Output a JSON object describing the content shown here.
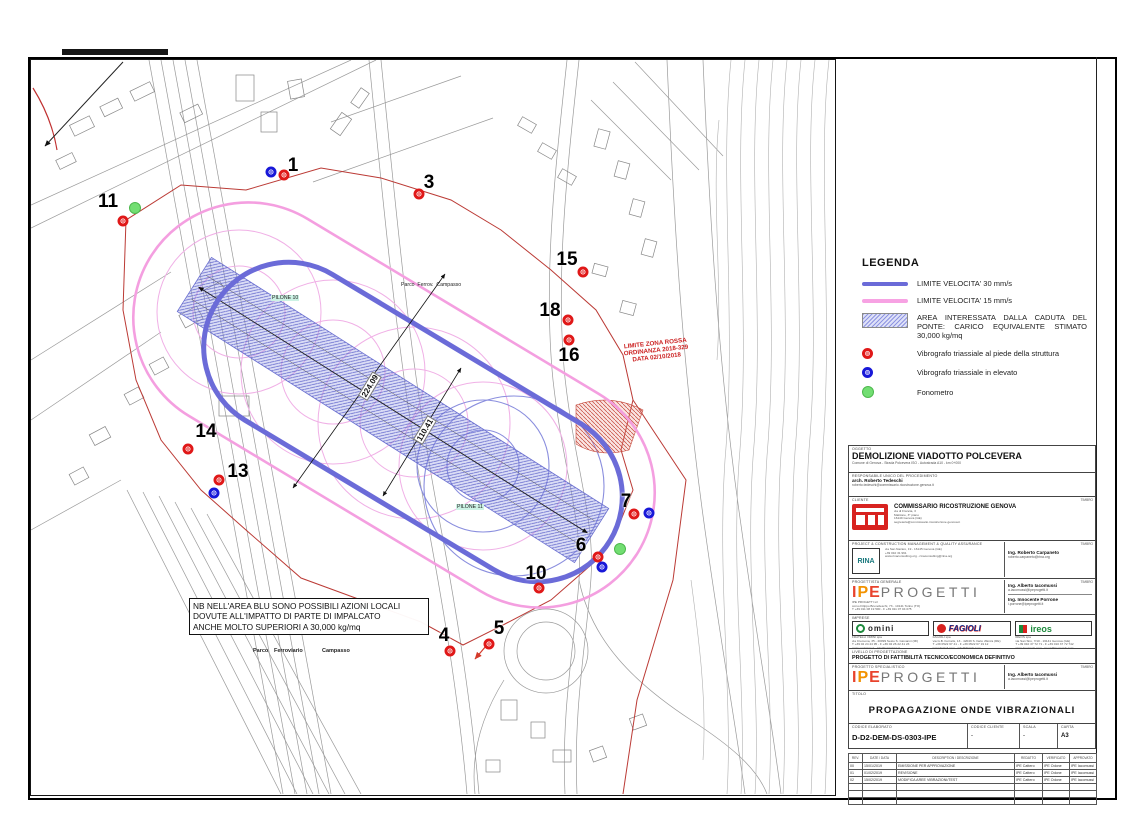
{
  "colors": {
    "limit_30": "#6b6bd8",
    "limit_15": "#f7a2e3",
    "impact_area": "#8e94e2",
    "marker_red": "#e01818",
    "marker_blue": "#1818d8",
    "marker_green": "#72de72",
    "red_zone": "#bb3a35"
  },
  "legend": {
    "title": "LEGENDA",
    "items": [
      {
        "type": "line-blue",
        "label": "LIMITE VELOCITA' 30 mm/s"
      },
      {
        "type": "line-pink",
        "label": "LIMITE VELOCITA' 15 mm/s"
      },
      {
        "type": "area",
        "label": "AREA INTERESSATA DALLA CADUTA DEL PONTE: CARICO EQUIVALENTE STIMATO 30,000 kg/mq"
      },
      {
        "type": "marker-red",
        "label": "Vibrografo triassiale al piede della struttura"
      },
      {
        "type": "marker-blue",
        "label": "Vibrografo triassiale in elevato"
      },
      {
        "type": "marker-green",
        "label": "Fonometro"
      }
    ]
  },
  "map": {
    "note_lines": [
      "NB NELL'AREA BLU SONO POSSIBILI  AZIONI LOCALI",
      "DOVUTE ALL'IMPATTO DI PARTE DI IMPALCATO",
      "ANCHE MOLTO SUPERIORI A 30,000 kg/mq"
    ],
    "red_zone_label_lines": [
      "LIMITE ZONA ROSSA",
      "ORDINANZA 2018-329",
      "DATA 02/10/2018"
    ],
    "pilone10": "PILONE 10",
    "pilone11": "PILONE 11",
    "parco_small": "Parco  Ferrov.  Campasso",
    "parco_bottom": [
      "Parco",
      "Ferroviario",
      "Campasso"
    ],
    "dim1": "224.09",
    "dim2": "110.41",
    "points": [
      {
        "label": "1",
        "nx": 262,
        "ny": 106,
        "markers": [
          {
            "t": "blue",
            "x": 240,
            "y": 112
          },
          {
            "t": "red",
            "x": 253,
            "y": 115
          }
        ]
      },
      {
        "label": "3",
        "nx": 398,
        "ny": 123,
        "markers": [
          {
            "t": "red",
            "x": 388,
            "y": 134
          }
        ]
      },
      {
        "label": "11",
        "nx": 77,
        "ny": 142,
        "markers": [
          {
            "t": "green",
            "x": 104,
            "y": 148
          },
          {
            "t": "red",
            "x": 92,
            "y": 161
          }
        ]
      },
      {
        "label": "15",
        "nx": 536,
        "ny": 200,
        "markers": [
          {
            "t": "red",
            "x": 552,
            "y": 212
          }
        ]
      },
      {
        "label": "18",
        "nx": 519,
        "ny": 251,
        "markers": [
          {
            "t": "red",
            "x": 537,
            "y": 260
          }
        ]
      },
      {
        "label": "16",
        "nx": 538,
        "ny": 296,
        "markers": [
          {
            "t": "red",
            "x": 538,
            "y": 280
          }
        ]
      },
      {
        "label": "14",
        "nx": 175,
        "ny": 372,
        "markers": [
          {
            "t": "red",
            "x": 157,
            "y": 389
          }
        ]
      },
      {
        "label": "13",
        "nx": 207,
        "ny": 412,
        "markers": [
          {
            "t": "red",
            "x": 188,
            "y": 420
          },
          {
            "t": "blue",
            "x": 183,
            "y": 433
          }
        ]
      },
      {
        "label": "7",
        "nx": 595,
        "ny": 442,
        "markers": [
          {
            "t": "red",
            "x": 603,
            "y": 454
          },
          {
            "t": "blue",
            "x": 618,
            "y": 453
          }
        ]
      },
      {
        "label": "6",
        "nx": 550,
        "ny": 486,
        "markers": [
          {
            "t": "red",
            "x": 567,
            "y": 497
          },
          {
            "t": "blue",
            "x": 571,
            "y": 507
          },
          {
            "t": "green",
            "x": 589,
            "y": 489
          }
        ]
      },
      {
        "label": "10",
        "nx": 505,
        "ny": 514,
        "markers": [
          {
            "t": "red",
            "x": 508,
            "y": 528
          }
        ]
      },
      {
        "label": "5",
        "nx": 468,
        "ny": 569,
        "markers": [
          {
            "t": "red",
            "x": 458,
            "y": 584
          }
        ]
      },
      {
        "label": "4",
        "nx": 413,
        "ny": 576,
        "markers": [
          {
            "t": "red",
            "x": 419,
            "y": 591
          }
        ]
      }
    ]
  },
  "titleblock": {
    "oggetto_label": "OGGETTO",
    "oggetto": "DEMOLIZIONE VIADOTTO POLCEVERA",
    "oggetto_sub": "Comune di Genova - Strada Polcevera ISO - Autostrada A10 - km 0+000",
    "rup_label": "RESPONSABILE UNICO DEL PROCEDIMENTO",
    "rup_name": "arch. Roberto Tedeschi",
    "rup_email": "roberto.tedeschi@commissario.ricostruzione.genova.it",
    "timbro": "TIMBRO",
    "cliente_label": "CLIENTE",
    "cliente_name": "COMMISSARIO RICOSTRUZIONE GENOVA",
    "cliente_addr": [
      "via di Francia, 3",
      "Matitone, 3° piano",
      "16149 Genova (GE)",
      "segreteria@commissario.ricostruzione.genova.it"
    ],
    "pcm_label": "PROJECT & CONSTRUCTION MANAGEMENT & QUALITY ASSURANCE",
    "rina_logo": "RINA",
    "rina_name": "RINA CONSULTING spa",
    "rina_lines": [
      "via San Nazaro, 19 - 16145 Genova (GE)",
      "+39 010 31 961",
      "www.rinaconsulting.org - rinaconsulting@rina.org"
    ],
    "rina_eng": "Ing. Roberto Carpaneto",
    "rina_eng_email": "roberto.carpaneto@rina.org",
    "pg_label": "PROGETTISTA GENERALE",
    "ipe": {
      "l1": "I",
      "l2": "P",
      "l3": "E",
      "rest": "PROGETTI"
    },
    "ipe_lines": [
      "IPE PROGETTI srl",
      "corso Filippo Brunelleschi, 73 - 10141 Torino (TO)",
      "T +39 011 08 19 500 - F +39 011 07 04 075",
      "www.ipeprogetti.it - info@ipeprogetti.it"
    ],
    "pg_eng1": "Ing. Alberto Iacomussi",
    "pg_eng1_email": "a.iacomussi@ipeprogetti.it",
    "pg_eng2": "Ing. Innocente Porrone",
    "pg_eng2_email": "i.porrone@ipeprogetti.it",
    "imprese_label": "IMPRESE",
    "omini_name": "omini",
    "omini_lines": [
      "FRATELLI OMINI spa",
      "via Cremona, 35 - 20099 Sesto S. Giovanni (MI)",
      "T +39 02 24 44 95 - F +39 02 26 22 41 23",
      "www.ominispa.it - info@ominispa.it"
    ],
    "fagioli_name": "FAGIOLI",
    "fagioli_lines": [
      "FAGIOLI spa",
      "via G.B. Ferraris, 13 - 42049 S. Ilario d'Enza (RE)",
      "T +39 0522 67 41 - F +39 0522 67 19 12",
      "www.fagioli.com - info@fagioli.com"
    ],
    "ireos_name": "ireos",
    "ireos_lines": [
      "IREOS spa",
      "via San Siro, 7/10 - 16141 Genova (GE)",
      "T +39 010 37 72 71 - F +39 010 37 72 742",
      "www.ireosweb.com - ireos@ireosweb.com"
    ],
    "livello_label": "LIVELLO DI PROGETTAZIONE",
    "livello": "PROGETTO DI FATTIBILITÀ TECNICO/ECONOMICA DEFINITIVO",
    "spec_label": "PROGETTO SPECIALISTICO",
    "spec_eng": "Ing. Alberto Iacomussi",
    "spec_eng_email": "a.iacomussi@ipeprogetti.it",
    "titolo_label": "TITOLO",
    "titolo": "PROPAGAZIONE ONDE VIBRAZIONALI",
    "codice_label": "CODICE ELABORATO",
    "codice": "D-D2-DEM-DS-0303-IPE",
    "codcli_label": "CODICE CLIENTE",
    "codcli": "-",
    "scala_label": "SCALA",
    "scala": "-",
    "carta_label": "CARTA",
    "carta": "A3",
    "rev_headers": [
      "REV.",
      "DATE / DATA",
      "DESCRIPTION / DESCRIZIONE",
      "REDATTO",
      "VERIFICATO",
      "APPROVATO"
    ],
    "revisions": [
      {
        "rev": "00",
        "date": "15/01/2019",
        "desc": "EMISSIONE PER APPROVAZIONE",
        "a": "IPE Cattero",
        "b": "IPE Odone",
        "c": "IPE Iacomussi"
      },
      {
        "rev": "01",
        "date": "01/02/2019",
        "desc": "REVISIONE",
        "a": "IPE Cattero",
        "b": "IPE Odone",
        "c": "IPE Iacomussi"
      },
      {
        "rev": "02",
        "date": "15/02/2019",
        "desc": "MODIFICA AREE VIBRAZIONI/TEST",
        "a": "IPE Cattero",
        "b": "IPE Odone",
        "c": "IPE Iacomussi"
      },
      {
        "rev": "",
        "date": "",
        "desc": "",
        "a": "",
        "b": "",
        "c": ""
      },
      {
        "rev": "",
        "date": "",
        "desc": "",
        "a": "",
        "b": "",
        "c": ""
      },
      {
        "rev": "",
        "date": "",
        "desc": "",
        "a": "",
        "b": "",
        "c": ""
      }
    ]
  }
}
